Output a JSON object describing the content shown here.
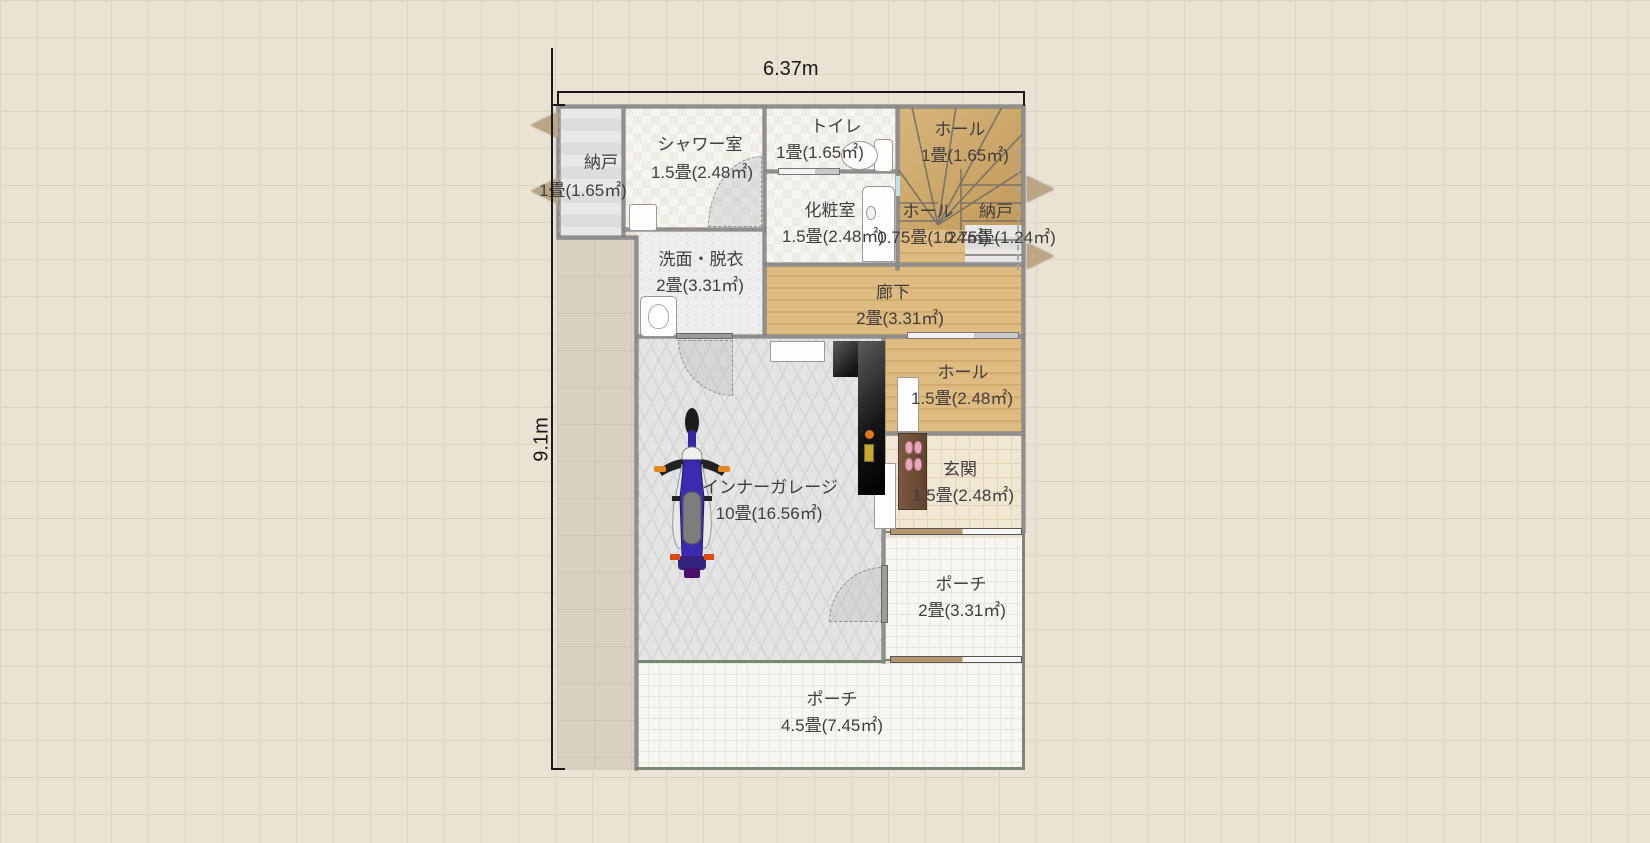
{
  "canvas": {
    "bg": "#eae2d2",
    "grid": "#ddd4c3"
  },
  "dimensions": {
    "width_label": "6.37m",
    "height_label": "9.1m"
  },
  "rooms": [
    {
      "id": "nando-left",
      "name": "納戸",
      "area": "1畳(1.65㎡)"
    },
    {
      "id": "shower",
      "name": "シャワー室",
      "area": "1.5畳(2.48㎡)"
    },
    {
      "id": "toilet",
      "name": "トイレ",
      "area": "1畳(1.65㎡)"
    },
    {
      "id": "hall-stairs",
      "name": "ホール",
      "area": "1畳(1.65㎡)"
    },
    {
      "id": "keshoshitsu",
      "name": "化粧室",
      "area": "1.5畳(2.48㎡)"
    },
    {
      "id": "hall-mini",
      "name": "ホール",
      "area": "0.75畳(1.24㎡)"
    },
    {
      "id": "nando-right",
      "name": "納戸",
      "area": "0.75畳(1.24㎡)"
    },
    {
      "id": "senmen",
      "name": "洗面・脱衣",
      "area": "2畳(3.31㎡)"
    },
    {
      "id": "rouka",
      "name": "廊下",
      "area": "2畳(3.31㎡)"
    },
    {
      "id": "garage",
      "name": "インナーガレージ",
      "area": "10畳(16.56㎡)"
    },
    {
      "id": "hall-15",
      "name": "ホール",
      "area": "1.5畳(2.48㎡)"
    },
    {
      "id": "genkan",
      "name": "玄関",
      "area": "1.5畳(2.48㎡)"
    },
    {
      "id": "porch-2",
      "name": "ポーチ",
      "area": "2畳(3.31㎡)"
    },
    {
      "id": "porch-45",
      "name": "ポーチ",
      "area": "4.5畳(7.45㎡)"
    }
  ],
  "objects": {
    "motorcycle": "motorcycle-icon",
    "toilet_fixture": "toilet-icon",
    "washbasin": "washbasin-icon",
    "powder_basin": "washbasin-icon",
    "slippers": "slippers-icon",
    "stairs": "stairs-icon",
    "doors": "door-swing-icon"
  },
  "colors": {
    "wood": "#d8b57c",
    "garage_floor": "#e4e4e4",
    "tile_beige": "#f0e7d3",
    "tile_white": "#f8f6f1",
    "wall": "#8f8f8f",
    "wall_green": "#7c8877",
    "black_cabinet": "#161616",
    "step_brown": "#6b4e38",
    "slipper_pink": "#e8a7b8",
    "arrow_tan": "#bca582",
    "accent_orange": "#e07818",
    "accent_yellow": "#c8a830"
  }
}
